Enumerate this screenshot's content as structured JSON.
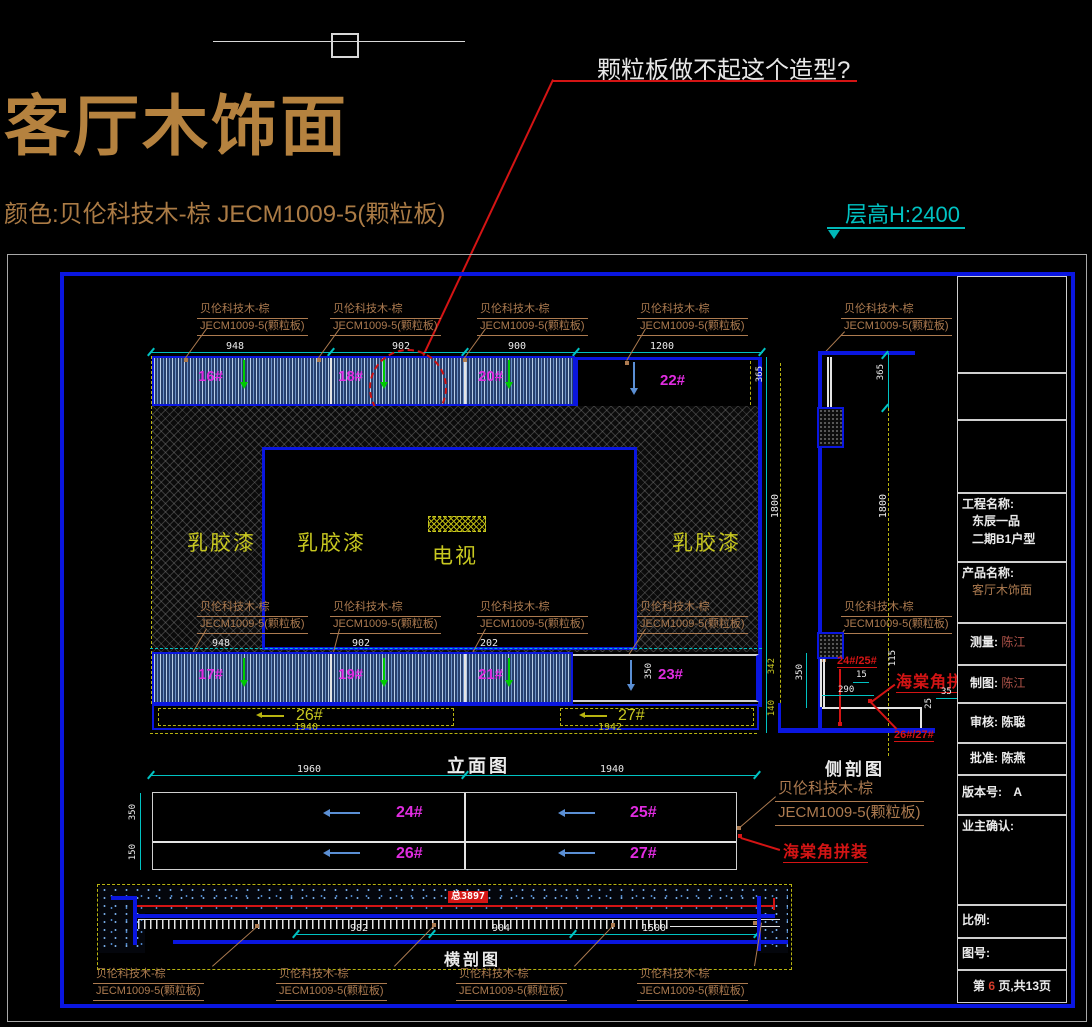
{
  "colors": {
    "cad_blue": "#0a16e0",
    "cyan": "#00c2c2",
    "magenta": "#e02ce0",
    "yellow": "#c8c820",
    "brown": "#ad7b50",
    "red": "#d41414"
  },
  "header": {
    "title": "客厅木饰面",
    "subtitle": "颜色:贝伦科技木-棕  JECM1009-5(颗粒板)",
    "annotation": "颗粒板做不起这个造型?",
    "floor_height": "层高H:2400"
  },
  "material": {
    "line1": "贝伦科技木-棕",
    "line2": "JECM1009-5(颗粒板)"
  },
  "labels": {
    "miter": "海棠角拼装"
  },
  "elevation": {
    "title": "立面图",
    "paint": "乳胶漆",
    "tv": "电视",
    "top_panels": [
      "16#",
      "18#",
      "20#",
      "22#"
    ],
    "bottom_panels": [
      "17#",
      "19#",
      "21#",
      "23#"
    ],
    "strip_panels": [
      "26#",
      "27#"
    ],
    "dims_top": [
      "948",
      "902",
      "900",
      "1200"
    ],
    "dims_mid": [
      "948",
      "902",
      "202"
    ],
    "dims_yellow": [
      "1940",
      "1942"
    ],
    "dims_cyan": [
      "1960",
      "1940"
    ],
    "dim_right": "365",
    "dim_height_a": "1800",
    "dim_340": "342",
    "dim_140": "140",
    "dim_350": "350"
  },
  "plan": {
    "panels": [
      "24#",
      "25#",
      "26#",
      "27#"
    ],
    "dim_top_row": "350",
    "dim_bottom_row": "150"
  },
  "side": {
    "title": "侧剖图",
    "tag_top": "24#/25#",
    "tag_bottom": "26#/27#",
    "dim_365": "365",
    "dim_1800": "1800",
    "dim_350": "350",
    "dim_290": "290",
    "dim_15": "15",
    "dim_115": "115",
    "dim_25": "25",
    "dim_35": "35"
  },
  "cross": {
    "title": "横剖图",
    "total": "总3897",
    "dims": [
      "982",
      "904",
      "1500"
    ]
  },
  "titleblock": {
    "project_label": "工程名称:",
    "project_line1": "东辰一品",
    "project_line2": "二期B1户型",
    "product_label": "产品名称:",
    "product_value": "客厅木饰面",
    "survey_label": "测量:",
    "survey_value": "陈江",
    "draft_label": "制图:",
    "draft_value": "陈江",
    "audit_label": "审核:",
    "audit_value": "陈聪",
    "approve_label": "批准:",
    "approve_value": "陈燕",
    "version_label": "版本号:",
    "version_value": "A",
    "owner_label": "业主确认:",
    "scale_label": "比例:",
    "figno_label": "图号:",
    "page_prefix": "第",
    "page_number": "6",
    "page_suffix": "页,共13页"
  }
}
